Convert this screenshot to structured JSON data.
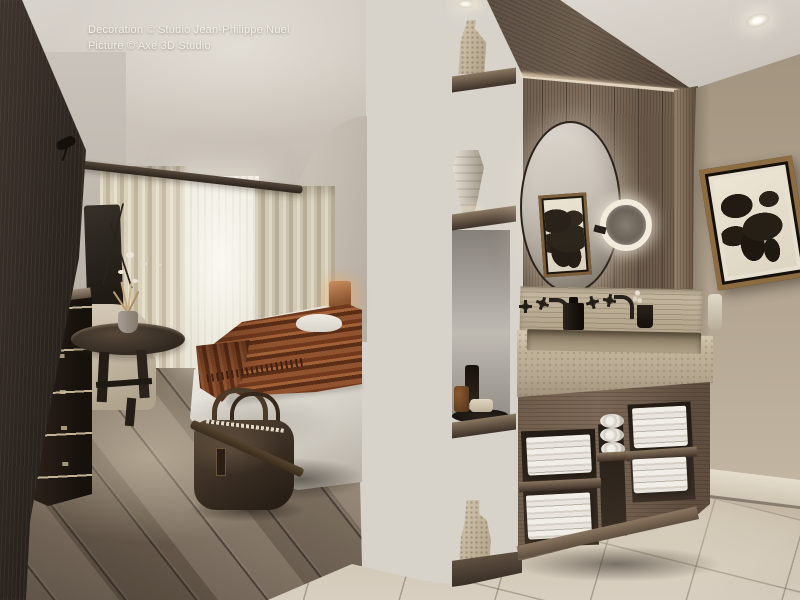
{
  "scene": {
    "kind": "photorealistic interior rendering",
    "description": "Hotel guest room visualization: bedroom with bed, rust throw, leather duffel bag, antique dresser, round table and sheer-curtained window on the left; tall oak room-divider with display niches in the center; open bathroom on the right with round backlit mirror, magnifying ring-light mirror, travertine trough sink, dark bronze wall faucets, towel cubbies, framed botanical art and stone tile floor.",
    "overlay": {
      "credit_line_1": "Decoration © Studio Jean-Philippe Nuel",
      "credit_line_2": "Picture © Axe 3D Studio"
    },
    "palette": {
      "plaster_ceiling": "#d5d0c9",
      "dark_wood_panel": "#2b241e",
      "curtain_cream": "#ddd4bf",
      "window_glow": "#f4f1e8",
      "duvet_white": "#e8e5df",
      "throw_rust": "#8a4c28",
      "leather_bag": "#3c3024",
      "wood_floor": "#8b7d6c",
      "oak_divider": "#63564a",
      "bath_wood_wall": "#7c6b5b",
      "right_wall_greige": "#b3a591",
      "travertine_sink": "#c1b39c",
      "towel_white": "#efece6",
      "ring_light": "#f3ecdd",
      "stone_floor": "#c8beac",
      "art_frame_bronze": "#8d6c41"
    },
    "visible_objects": [
      "bedroom ceiling with track spotlight",
      "sheer window with cream curtains and dark curtain rail",
      "bed with white duvet, rust fringed throw and pillow",
      "amber table lamp",
      "dark dresser with bone trim and orchid",
      "round pedestal table with dried-grass vase",
      "beige armchair",
      "brown leather duffel bag on plank floor",
      "dark wood wardrobe panel (foreground left)",
      "oak room divider with display niches",
      "textured ceramic vases and urn on niche shelves",
      "tray with amber apothecary bottles and soap",
      "round backlit mirror",
      "illuminated magnifying mirror",
      "framed botanical print reflected in mirror",
      "framed botanical print on right wall",
      "travertine backsplash and trough sink",
      "two dark bronze wall-mounted faucet sets",
      "black soap dispenser and tumbler",
      "vanity cubbies with folded and rolled white towels",
      "recessed ceiling spotlights",
      "white baseboard",
      "stone tile bathroom floor"
    ]
  }
}
